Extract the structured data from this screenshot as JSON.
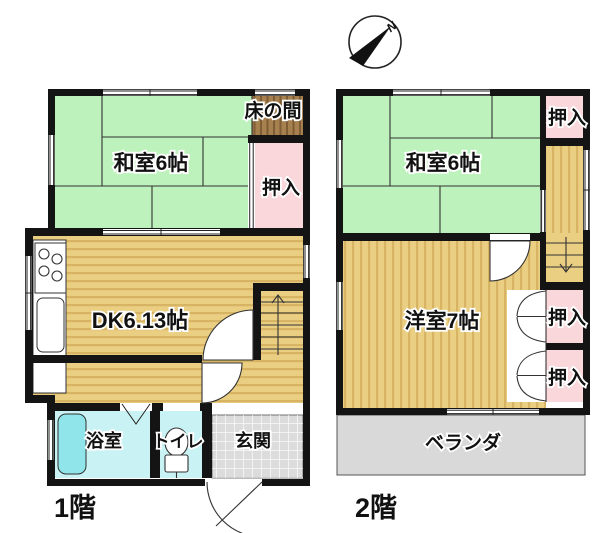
{
  "compass": {
    "north_label": "N"
  },
  "floor1": {
    "title": "1階",
    "washitsu_label": "和室6帖",
    "tokonoma_label": "床の間",
    "oshiire_label": "押入",
    "dk_label": "DK6.13帖",
    "bath_label": "浴室",
    "toilet_label": "トイレ",
    "entrance_label": "玄関"
  },
  "floor2": {
    "title": "2階",
    "washitsu_label": "和室6帖",
    "oshiire_top_label": "押入",
    "western_room_label": "洋室7帖",
    "oshiire_mid_label": "押入",
    "oshiire_bottom_label": "押入",
    "veranda_label": "ベランダ"
  },
  "colors": {
    "tatami_green": "#bdf2bc",
    "wood_tan": "#eace82",
    "closet_pink": "#f9d7da",
    "tokonoma_brown": "#a6804f",
    "wet_room_cyan": "#c9f2f4",
    "bathtub_cyan": "#8fe5ea",
    "entry_gray": "#dcdcdc",
    "veranda_gray": "#d9d9d9",
    "wall_black": "#141414"
  }
}
